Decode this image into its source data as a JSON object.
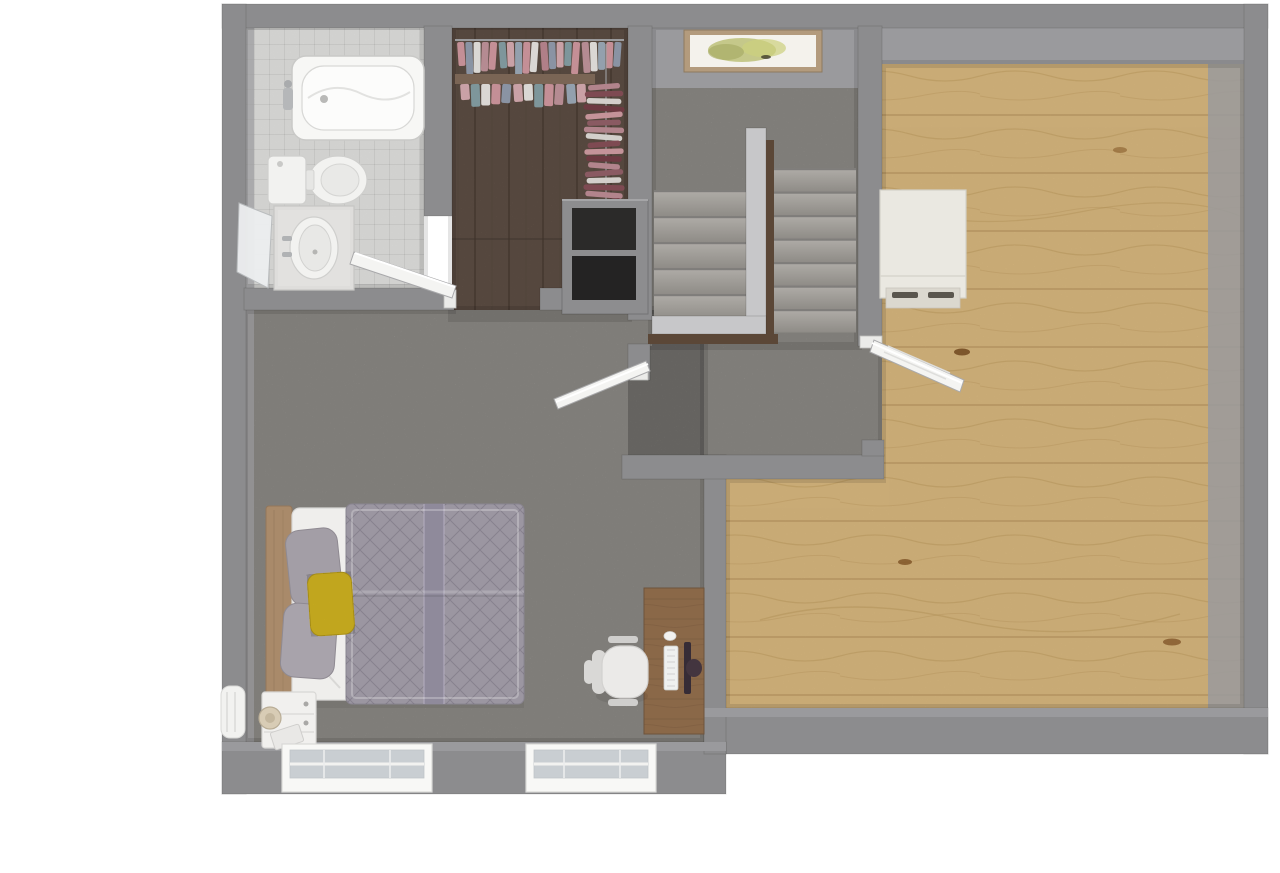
{
  "scene": {
    "kind": "3d-floorplan-top-view",
    "floors_visible": [
      "white-tile",
      "dark-wood-plank",
      "gray-carpet",
      "light-oak-plank"
    ],
    "doors_open_count": 3,
    "windows_count": 2
  },
  "colors": {
    "wall": "#8c8c8e",
    "wallFace": "#9a9a9d",
    "carpet": "#a09d98",
    "tile": "#e4e4e2",
    "darkwood": "#6e5c50",
    "oak": "#ddbc82",
    "oakSeam": "#c2a067",
    "oakGrain": "#c49f60",
    "kneewall": "#c7c7c9",
    "rail": "#5b4737",
    "picFrame": "#b39b7d",
    "picCanvas": "#f4f2ec",
    "picArt": "#b9bd72",
    "doorLeaf": "#f4f4f2",
    "glass": "#c9ced2",
    "winFrame": "#f8f8f6",
    "tub": "#f7f7f5",
    "counter": "#dedddb",
    "fixture": "#f2f2f0",
    "cubby": "#2b2a29",
    "shelfWood": "#7a6555",
    "cabinet": "#eae8e1",
    "sheet": "#efeeec",
    "comforter": "#9b96a1",
    "comfFold": "#8f8a9b",
    "pillowGray": "#a39ea6",
    "pillowYellow": "#e4c424",
    "headboard": "#a98a6a",
    "nightstand": "#f1f0ee",
    "lamp": "#d8ccb5",
    "desk": "#8a6848",
    "chair": "#ebeae8",
    "monitor": "#43353f",
    "keyboard": "#eff0ef"
  },
  "rooms": [
    {
      "id": "bathroom",
      "floor": "white-tile",
      "fixtures": [
        "bathtub",
        "toilet",
        "vanity-sink",
        "shower-panel"
      ]
    },
    {
      "id": "walk-in-closet",
      "floor": "dark-wood-plank",
      "fixtures": [
        "clothes-rack-top",
        "clothes-rack-side",
        "shelf-unit"
      ]
    },
    {
      "id": "staircase",
      "floor": "gray-carpet",
      "fixtures": [
        "left-flight",
        "right-flight",
        "knee-wall",
        "handrail",
        "picture-frame"
      ]
    },
    {
      "id": "hallway",
      "floor": "gray-carpet",
      "fixtures": []
    },
    {
      "id": "bedroom",
      "floor": "gray-carpet",
      "fixtures": [
        "bed",
        "nightstand",
        "lamp",
        "desk",
        "office-chair",
        "keyboard",
        "monitor",
        "mouse"
      ]
    },
    {
      "id": "open-room",
      "floor": "light-oak-plank",
      "fixtures": [
        "white-cabinet"
      ]
    }
  ],
  "stairs": {
    "left_flight_steps": 5,
    "right_flight_steps": 7
  },
  "closet": {
    "top_rack_colors": [
      "#c48f96",
      "#8a93a3",
      "#dad7d4",
      "#b58b92",
      "#c48f96",
      "#7e969b",
      "#c9a1a6",
      "#93a0ad",
      "#c48f96",
      "#dad7d4",
      "#b07f88",
      "#8a93a3",
      "#c9a1a6",
      "#7e969b",
      "#c48f96",
      "#b58b92",
      "#dad7d4",
      "#93a0ad",
      "#c48f96",
      "#8a93a3"
    ],
    "second_row_colors": [
      "#c9a1a6",
      "#7e969b",
      "#dad7d4",
      "#c48f96",
      "#8a93a3",
      "#c9a1a6",
      "#dad7d4",
      "#7e969b",
      "#c48f96",
      "#b58b92",
      "#93a0ad",
      "#c9a1a6"
    ],
    "side_rack_colors": [
      "#b2848c",
      "#7e4a52",
      "#d3cfcb",
      "#6d3a42",
      "#c49399",
      "#8a5a62",
      "#b2848c",
      "#d3cfcb",
      "#7e4a52",
      "#c49399",
      "#6d3a42",
      "#b2848c",
      "#8a5a62",
      "#d3cfcb",
      "#7e4a52",
      "#b2848c",
      "#6d3a42"
    ]
  },
  "bed": {
    "pillows": [
      "gray",
      "gray",
      "yellow"
    ],
    "comforter_pattern": "diamond-quilt"
  },
  "windows": {
    "count": 2,
    "frame": "white",
    "style": "double-pane"
  }
}
